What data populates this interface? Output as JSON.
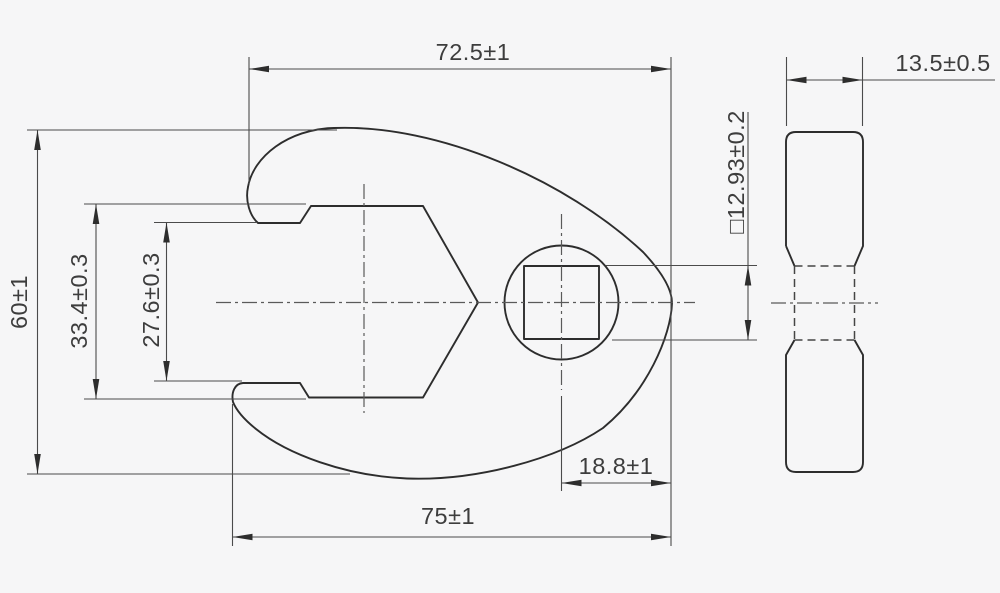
{
  "drawing_colors": {
    "background": "#f6f6f7",
    "object_line": "#2d2d2d",
    "dimension_line": "#4b4b4b",
    "text": "#3d3d3d"
  },
  "front_view": {
    "dimensions": {
      "top_width": {
        "label": "72.5±1",
        "value": 72.5,
        "tolerance": 1
      },
      "bottom_width": {
        "label": "75±1",
        "value": 75,
        "tolerance": 1
      },
      "overall_height": {
        "label": "60±1",
        "value": 60,
        "tolerance": 1
      },
      "jaw_opening_wide": {
        "label": "33.4±0.3",
        "value": 33.4,
        "tolerance": 0.3
      },
      "jaw_opening_narrow": {
        "label": "27.6±0.3",
        "value": 27.6,
        "tolerance": 0.3
      },
      "square_drive": {
        "label": "□12.93±0.2",
        "value": 12.93,
        "tolerance": 0.2
      },
      "drive_to_tip": {
        "label": "18.8±1",
        "value": 18.8,
        "tolerance": 1
      }
    }
  },
  "side_view": {
    "dimensions": {
      "thickness": {
        "label": "13.5±0.5",
        "value": 13.5,
        "tolerance": 0.5
      }
    }
  }
}
